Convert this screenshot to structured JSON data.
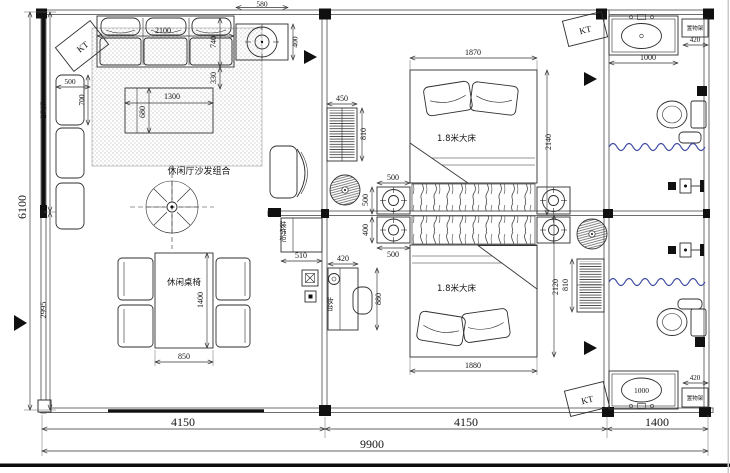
{
  "labels": {
    "rug_area": "休闲厅沙发组合",
    "dining_set": "休闲桌椅",
    "bed_queen": "1.8米大床",
    "deco_cabinet": "装饰柜",
    "dresser": "妆台",
    "shelf_rack": "置物架",
    "ac_unit": "KT"
  },
  "dims": {
    "sofa_width": "2100",
    "sofa_depth": "740",
    "sofa_front": "330",
    "fancoil_top_w": "580",
    "fancoil_top_h": "400",
    "side_table_w": "500",
    "side_table_h": "700",
    "coffee_table_w": "1300",
    "coffee_table_h": "680",
    "dining_table_w": "850",
    "dining_table_l": "1400",
    "deco_cabinet_w": "510",
    "dresser_w": "420",
    "dresser_h": "880",
    "wardrobe1_w": "450",
    "wardrobe1_h": "810",
    "wardrobe2_h": "810",
    "bed1_w": "1870",
    "bed1_l": "2140",
    "bed2_w": "1880",
    "bed2_l": "2120",
    "fc1_w": "500",
    "fc1_h": "500",
    "fc2_h": "400",
    "fc2_w": "500",
    "vanity1_w": "1000",
    "shelf1_w": "420",
    "vanity2_label": "1000",
    "shelf2_w": "420",
    "bottom_seg1": "4150",
    "bottom_seg2": "4150",
    "bottom_seg3": "1400",
    "bottom_total": "9900",
    "left_seg1": "2767",
    "left_seg2": "2995",
    "left_total": "6100"
  }
}
